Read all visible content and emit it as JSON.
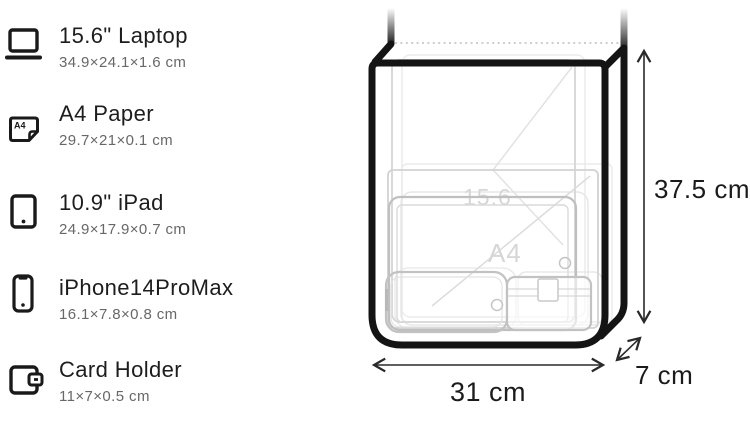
{
  "list": {
    "items": [
      {
        "name": "laptop",
        "title": "15.6\" Laptop",
        "dimensions": "34.9×24.1×1.6 cm"
      },
      {
        "name": "a4-paper",
        "title": "A4 Paper",
        "dimensions": "29.7×21×0.1 cm"
      },
      {
        "name": "ipad",
        "title": "10.9\" iPad",
        "dimensions": "24.9×17.9×0.7 cm"
      },
      {
        "name": "iphone",
        "title": "iPhone14ProMax",
        "dimensions": "16.1×7.8×0.8 cm"
      },
      {
        "name": "card-holder",
        "title": "Card Holder",
        "dimensions": "11×7×0.5 cm"
      }
    ],
    "a4_icon_label": "A4"
  },
  "diagram": {
    "height_label": "37.5 cm",
    "width_label": "31 cm",
    "depth_label": "7 cm",
    "watermarks": {
      "laptop": "15.6",
      "paper": "A4"
    },
    "colors": {
      "outline": "#141414",
      "faint_item": "#c9c9c9",
      "dimension_text": "#1b1b1b"
    }
  }
}
